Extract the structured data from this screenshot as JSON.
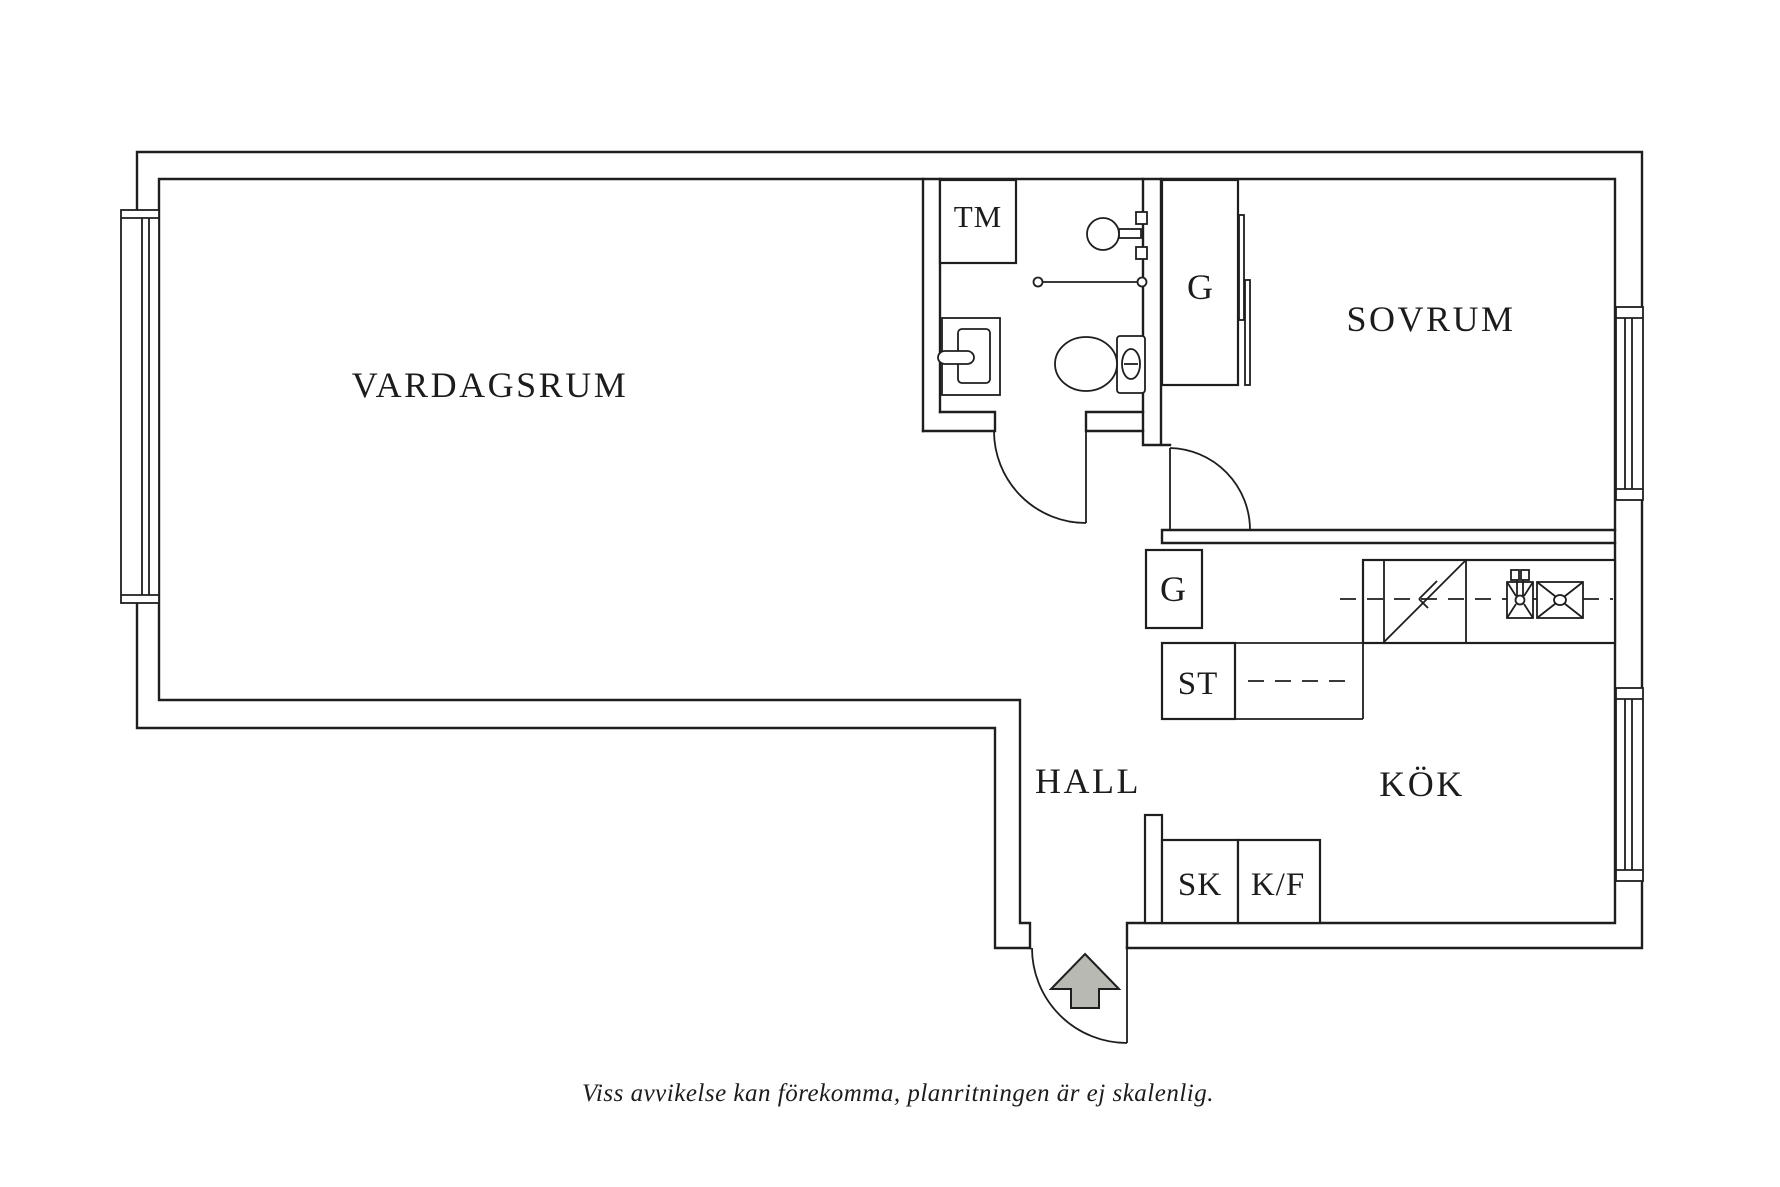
{
  "plan": {
    "rooms": {
      "living_room": "VARDAGSRUM",
      "bedroom": "SOVRUM",
      "hall": "HALL",
      "kitchen": "KÖK"
    },
    "units": {
      "washing_machine": "TM",
      "wardrobe_bedroom": "G",
      "wardrobe_hall": "G",
      "cleaning_cabinet": "ST",
      "hall_closet": "SK",
      "fridge_freezer": "K/F"
    },
    "caption": "Viss avvikelse kan förekomma, planritningen är ej skalenlig.",
    "colors": {
      "line": "#1e1e1e",
      "background": "#ffffff",
      "arrow_fill": "#b9b9b4",
      "arrow_stroke": "#6f6f6a"
    }
  }
}
